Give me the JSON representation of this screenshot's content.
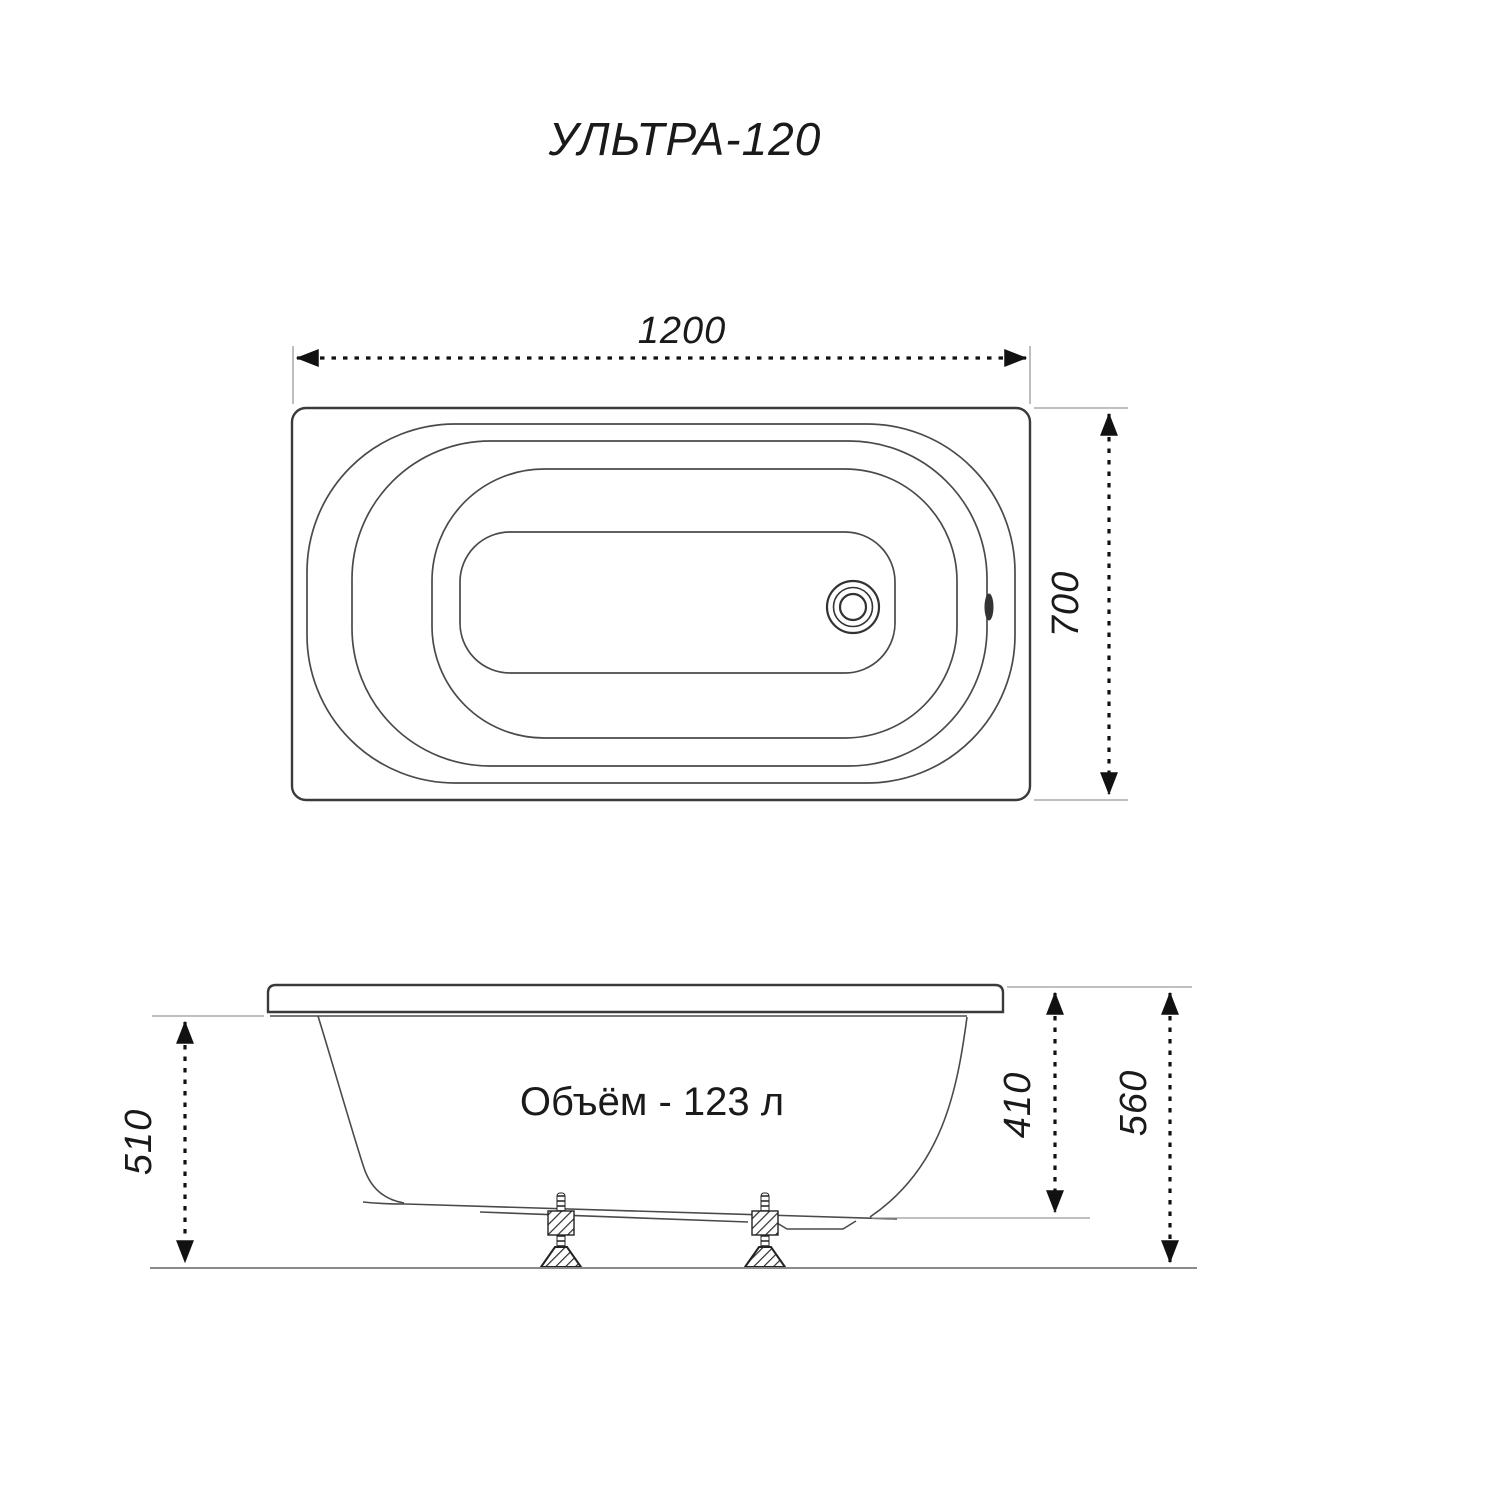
{
  "title": "УЛЬТРА-120",
  "top_view": {
    "length": "1200",
    "width": "700"
  },
  "side_view": {
    "rim_height": "510",
    "depth": "410",
    "overall_height": "560",
    "volume": "Объём - 123 л"
  },
  "colors": {
    "background": "#ffffff",
    "outline": "#3a3a3a",
    "dimension": "#111111",
    "extension": "#9a9a9a",
    "text": "#1a1a1a"
  }
}
